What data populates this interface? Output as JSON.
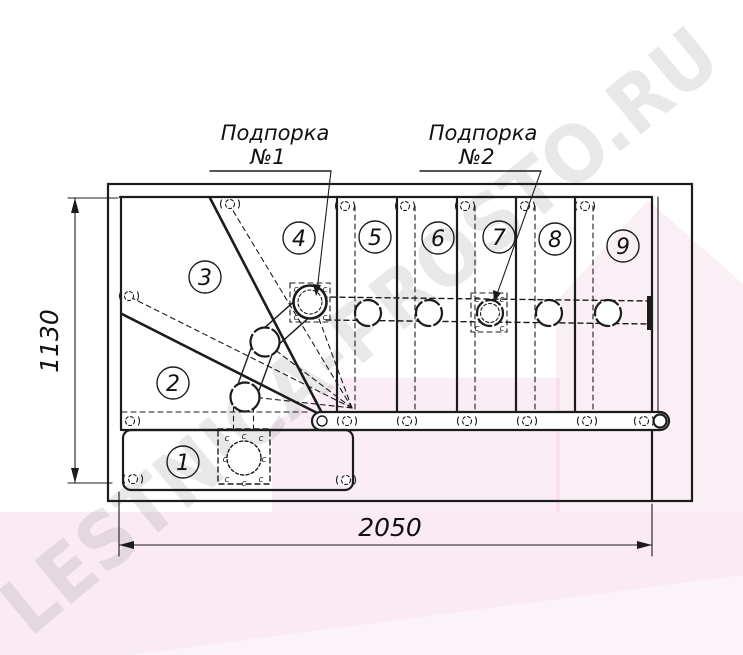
{
  "page": {
    "background": "#ffffff"
  },
  "drawing": {
    "type": "staircase-plan",
    "steps": [
      {
        "n": "1"
      },
      {
        "n": "2"
      },
      {
        "n": "3"
      },
      {
        "n": "4"
      },
      {
        "n": "5"
      },
      {
        "n": "6"
      },
      {
        "n": "7"
      },
      {
        "n": "8"
      },
      {
        "n": "9"
      }
    ],
    "supports": [
      {
        "title": "Подпорка",
        "number": "№1"
      },
      {
        "title": "Подпорка",
        "number": "№2"
      }
    ],
    "dimensions": {
      "horizontal": "2050",
      "vertical": "1130"
    },
    "connector_mark": "с",
    "colors": {
      "line": "#1c1c1c",
      "pink_overlay": "#eebbd8",
      "watermark": "#8a8a8a",
      "background": "#ffffff"
    }
  },
  "watermark": {
    "text": "LESTNICA-PROSTO.RU"
  }
}
